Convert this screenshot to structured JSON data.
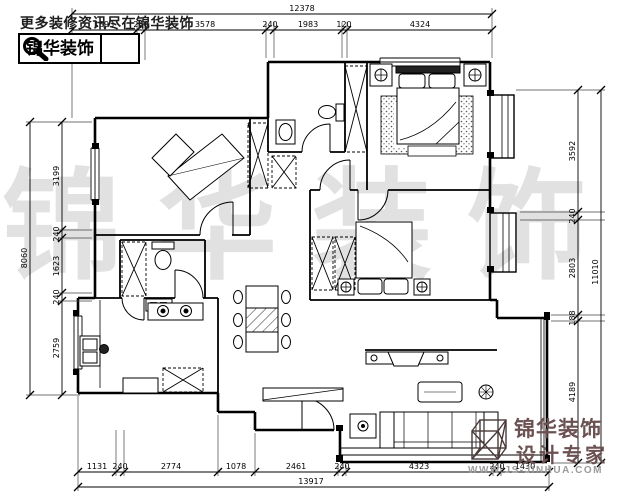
{
  "header": {
    "tagline": "更多装修资讯尽在锦华装饰",
    "logo_text": "锦华装饰",
    "search_icon": "magnifier-icon"
  },
  "watermark": {
    "chars": [
      "锦",
      "华",
      "装",
      "饰"
    ]
  },
  "footer_logo": {
    "brand": "锦华装饰",
    "subtitle": "设计专家",
    "website": "WWW.JS-JINHUA.COM",
    "icon": "cube-wireframe-icon"
  },
  "colors": {
    "line": "#000000",
    "brand_red": "#6b5151",
    "website_gray": "#9b9b9b",
    "watermark_gray": "#a0a0a0"
  },
  "dimensions": {
    "top": {
      "overall": "12378",
      "segments": [
        "1893",
        "240",
        "3578",
        "240",
        "1983",
        "120",
        "4324"
      ]
    },
    "bottom": {
      "overall": "13917",
      "segments": [
        "1131",
        "240",
        "2774",
        "1078",
        "2461",
        "240",
        "4323",
        "240",
        "1430"
      ]
    },
    "left": {
      "overall": "8060",
      "segments": [
        "3199",
        "240",
        "1623",
        "240",
        "2759"
      ]
    },
    "right": {
      "overall": "11010",
      "segments": [
        "3592",
        "240",
        "2803",
        "188",
        "4189"
      ]
    }
  }
}
